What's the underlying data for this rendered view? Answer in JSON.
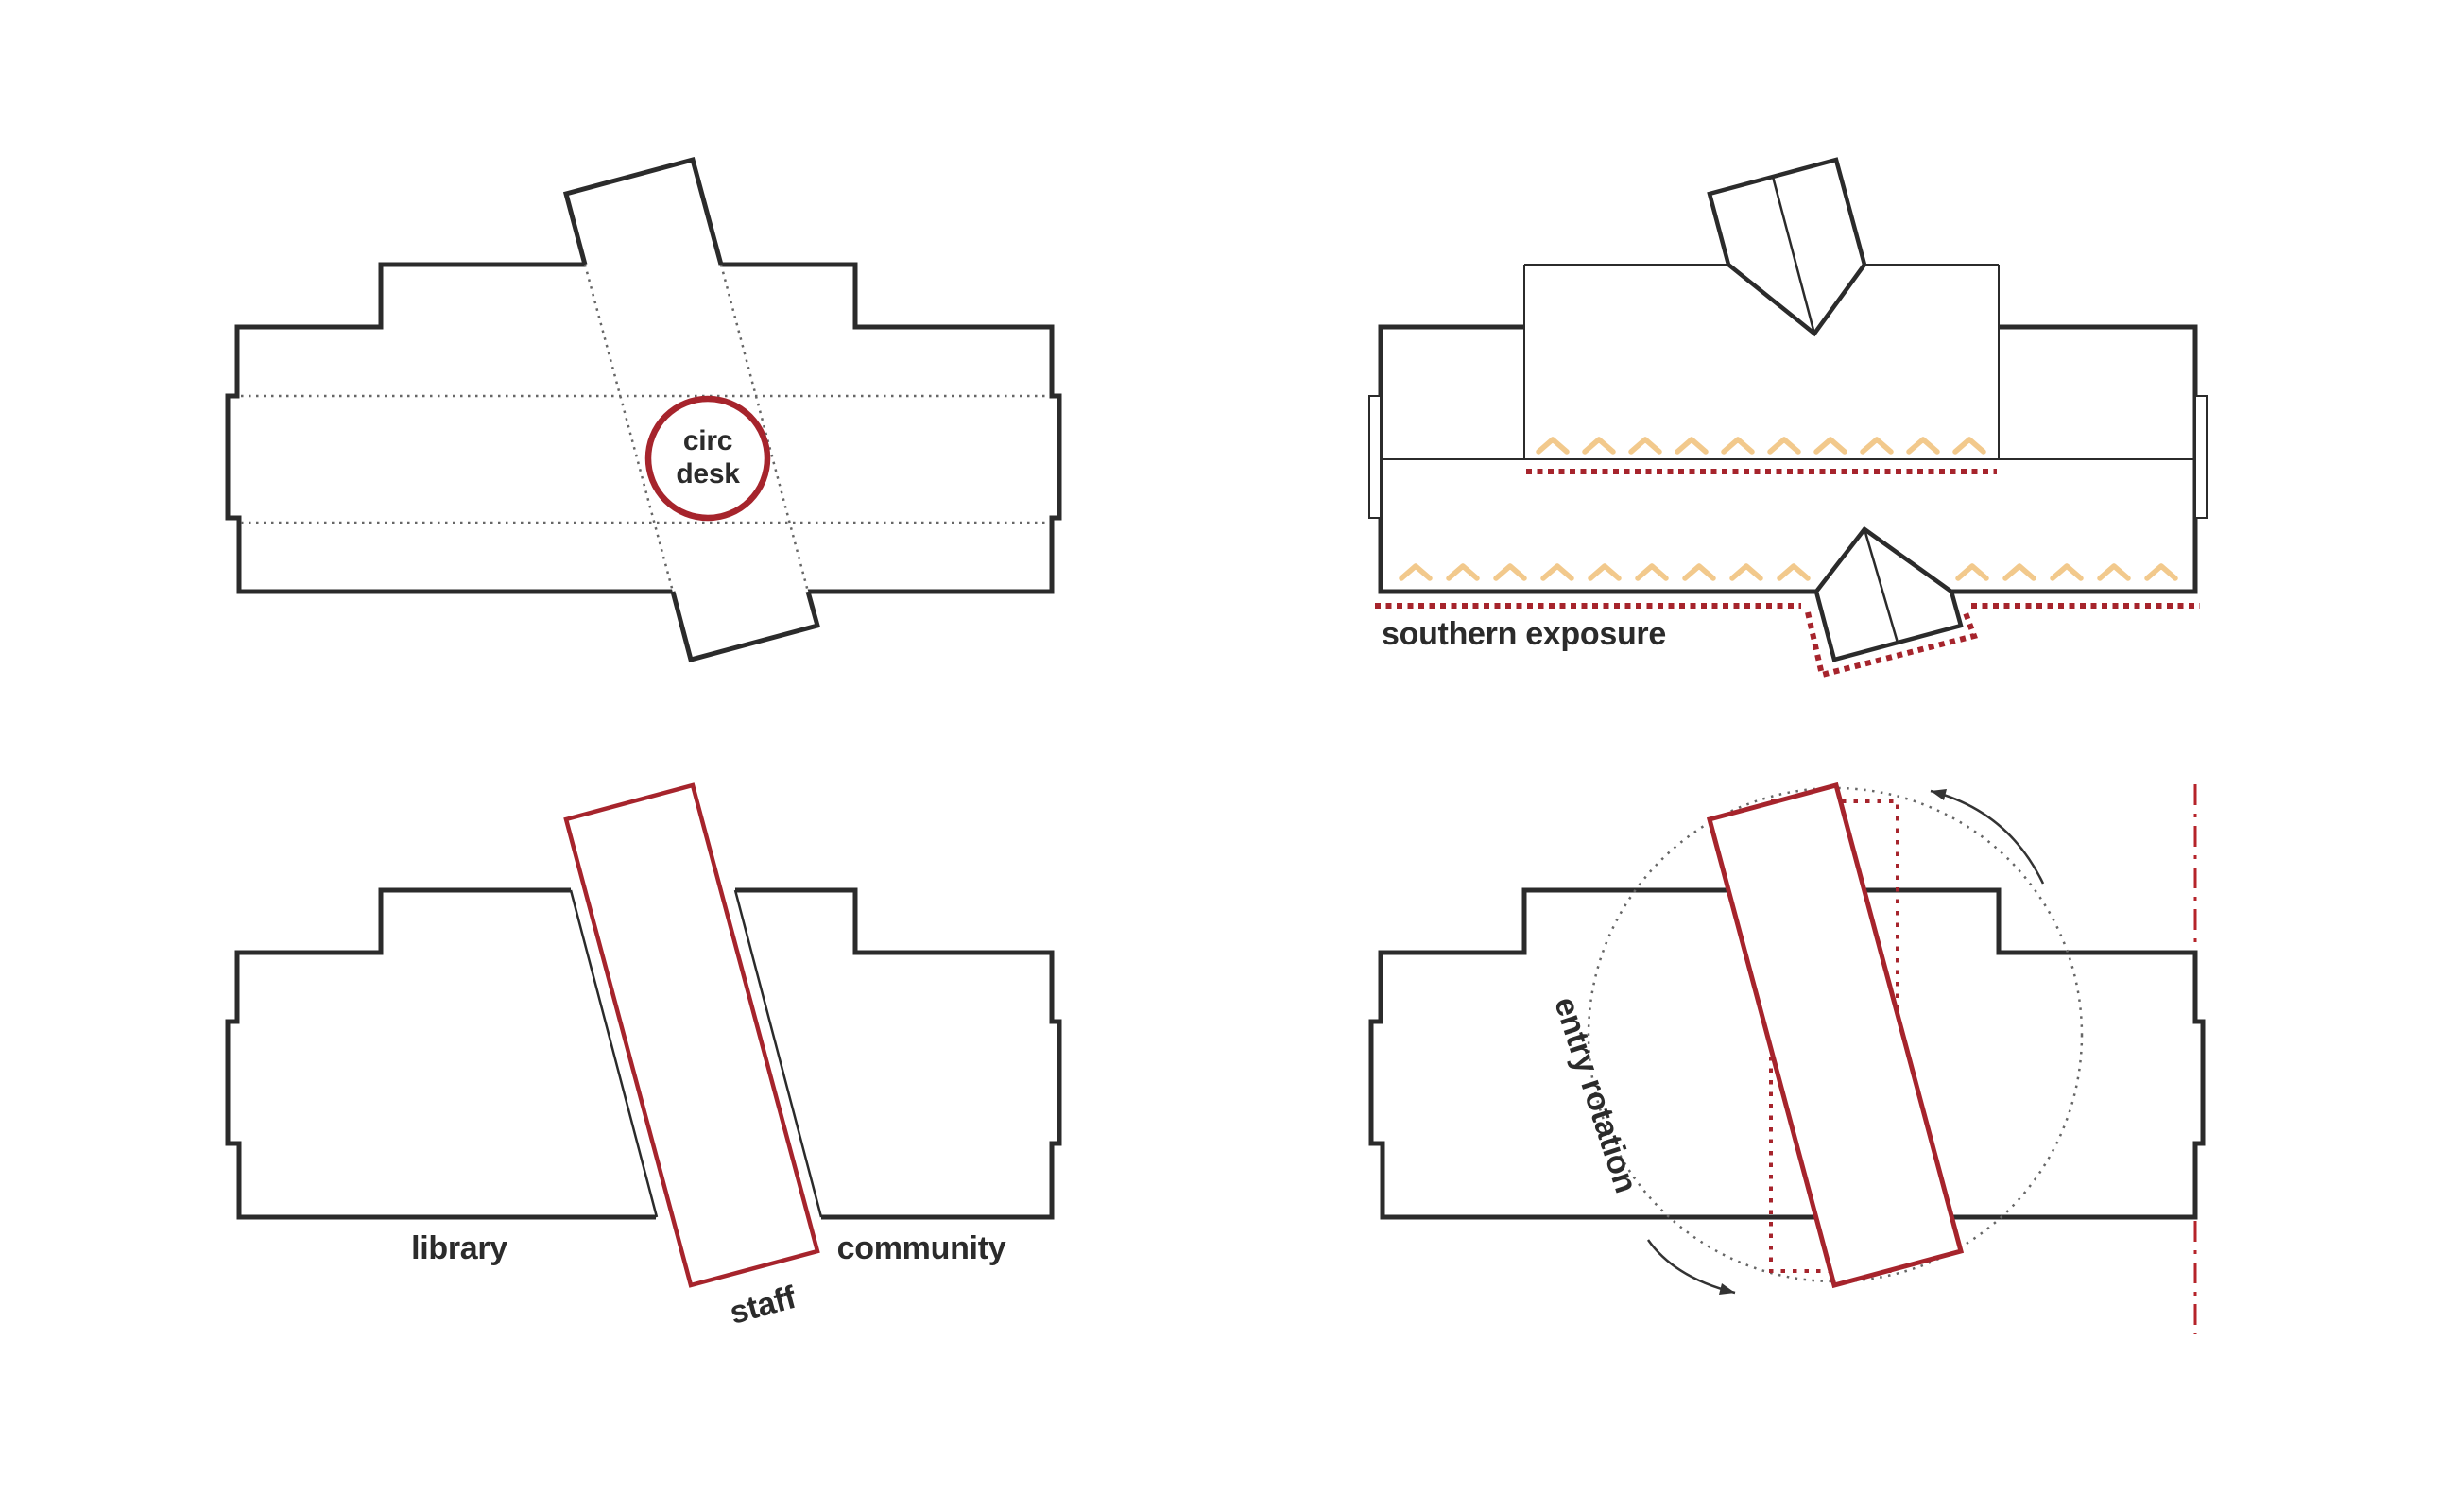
{
  "circulation": {
    "circle_line1": "circ",
    "circle_line2": "desk"
  },
  "southern_exposure": {
    "label": "southern exposure"
  },
  "program": {
    "library_label": "library",
    "staff_label": "staff",
    "community_label": "community"
  },
  "entry_rotation": {
    "label": "entry rotation"
  },
  "colors": {
    "line_black": "#2B2B2B",
    "accent_red": "#A6242C",
    "dash_dot_red": "#B5232A",
    "chevron_tan": "#F2C98C",
    "dot_gray": "#666666"
  }
}
